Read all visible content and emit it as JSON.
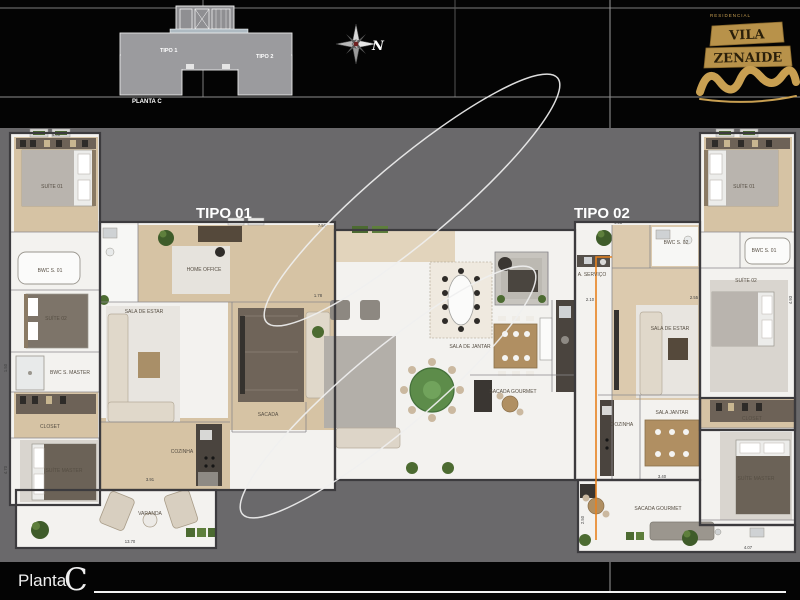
{
  "header": {
    "keyplan": {
      "tipo1": "TIPO 1",
      "tipo2": "TIPO 2",
      "caption": "PLANTA C"
    },
    "compass_label": "N",
    "logo": {
      "brand_small": "RESIDENCIAL",
      "brand_line1": "VILA",
      "brand_line2": "ZENAIDE"
    }
  },
  "plan": {
    "unit1_label": "TIPO 01",
    "unit2_label": "TIPO 02",
    "colors": {
      "accent_orange": "#e8821e",
      "backdrop_gray": "#6a696b",
      "gold": "#c9a052"
    },
    "rooms": {
      "suite01": "SUÍTE 01",
      "bwc01": "BWC S. 01",
      "suite02": "SUÍTE 02",
      "bwc_master": "BWC S. MASTER",
      "closet": "CLOSET",
      "suite_master": "SUÍTE MASTER",
      "varanda": "VARANDA",
      "home_office": "HOME OFFICE",
      "sala_estar": "SALA DE ESTAR",
      "sacada": "SACADA",
      "cozinha": "COZINHA",
      "servico": "A. SERVIÇO",
      "sala_jantar": "SALA DE JANTAR",
      "sacada_gourmet": "SACADA GOURMET",
      "bwc02": "BWC S. 02",
      "sala_estar2": "SALA DE ESTAR",
      "cozinha2": "COZINHA",
      "sala_jantar2": "SALA JANTAR",
      "closet2": "CLOSET",
      "suite_master2": "SUÍTE MASTER",
      "sacada_gourmet2": "SACADA GOURMET",
      "suite01_r": "SUÍTE 01",
      "bwc01_r": "BWC S. 01",
      "suite02_r": "SUÍTE 02"
    },
    "dimensions": [
      "4.00",
      "4.51",
      "1.78",
      "2.55",
      "3.91",
      "13.70",
      "3.40",
      "2.10",
      "1.50",
      "4.70",
      "7.56",
      "4.93",
      "4.07",
      "2.50"
    ]
  },
  "footer": {
    "label": "Planta",
    "letter": "C"
  }
}
